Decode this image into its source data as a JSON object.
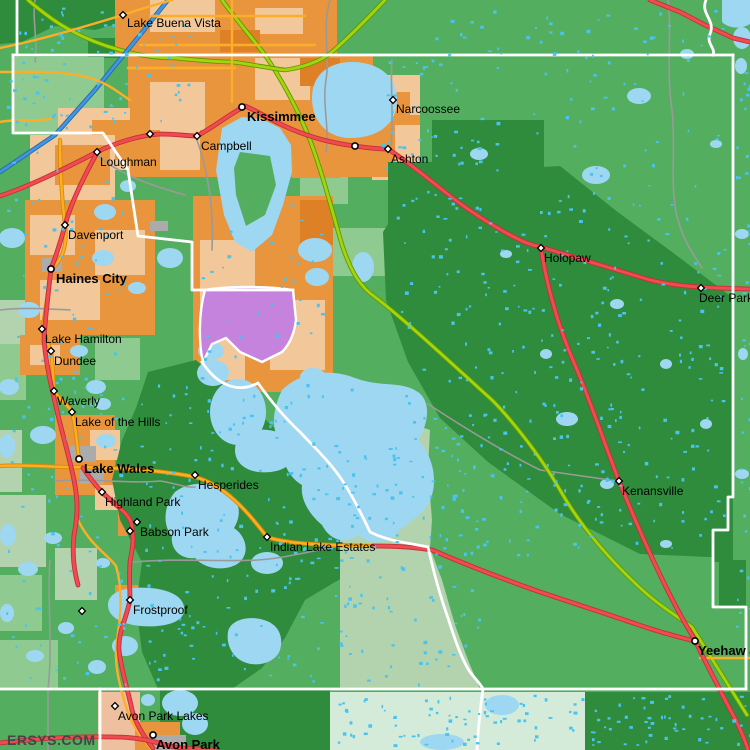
{
  "watermark": "ERSYS.COM",
  "palette": {
    "map_bg_green": "#54AE60",
    "dark_green": "#2E8C3C",
    "light_green": "#8FCB90",
    "sage_green": "#B2D3AE",
    "mint_green": "#D5EBDA",
    "orange_urban": "#E8953D",
    "tan_urban": "#F2C89B",
    "dark_orange": "#DD8026",
    "peach_urban": "#EFC0A0",
    "purple_area": "#C583DD",
    "gray_urban": "#ABABAB",
    "lake_blue": "#9ED7F2",
    "speckle_blue": "#49C3F0",
    "road_red": "#EF4B50",
    "road_yellow": "#FDAE28",
    "road_chartreuse": "#A5D40E",
    "road_blue": "#3F97E0",
    "road_gray": "#9A9A9A",
    "boundary_white": "#FFFFFF",
    "label_color": "#000000",
    "watermark_color": "#454545"
  },
  "towns": [
    {
      "label": "Lake Buena Vista",
      "marker": "diamond",
      "mx": 123,
      "my": 15,
      "lx": 127,
      "ly": 27,
      "bold": false
    },
    {
      "label": "Kissimmee",
      "marker": "circle",
      "mx": 242,
      "my": 107,
      "lx": 247,
      "ly": 121,
      "bold": true
    },
    {
      "label": "Narcoossee",
      "marker": "diamond",
      "mx": 393,
      "my": 100,
      "lx": 396,
      "ly": 113,
      "bold": false
    },
    {
      "label": "Campbell",
      "marker": "diamond",
      "mx": 197,
      "my": 136,
      "lx": 201,
      "ly": 150,
      "bold": false
    },
    {
      "label": "Ashton",
      "marker": "diamond",
      "mx": 388,
      "my": 149,
      "lx": 391,
      "ly": 163,
      "bold": false
    },
    {
      "label": "Loughman",
      "marker": "diamond",
      "mx": 97,
      "my": 152,
      "lx": 100,
      "ly": 166,
      "bold": false
    },
    {
      "label": "Davenport",
      "marker": "diamond",
      "mx": 65,
      "my": 225,
      "lx": 68,
      "ly": 239,
      "bold": false
    },
    {
      "label": "Haines City",
      "marker": "circle",
      "mx": 51,
      "my": 269,
      "lx": 56,
      "ly": 283,
      "bold": true
    },
    {
      "label": "Holopaw",
      "marker": "diamond",
      "mx": 541,
      "my": 248,
      "lx": 544,
      "ly": 262,
      "bold": false
    },
    {
      "label": "Deer Park",
      "marker": "diamond",
      "mx": 701,
      "my": 288,
      "lx": 699,
      "ly": 302,
      "bold": false
    },
    {
      "label": "Lake Hamilton",
      "marker": "diamond",
      "mx": 42,
      "my": 329,
      "lx": 45,
      "ly": 343,
      "bold": false
    },
    {
      "label": "Dundee",
      "marker": "diamond",
      "mx": 51,
      "my": 351,
      "lx": 54,
      "ly": 365,
      "bold": false
    },
    {
      "label": "Waverly",
      "marker": "diamond",
      "mx": 54,
      "my": 391,
      "lx": 57,
      "ly": 405,
      "bold": false
    },
    {
      "label": "Lake of the Hills",
      "marker": "diamond",
      "mx": 72,
      "my": 412,
      "lx": 75,
      "ly": 426,
      "bold": false
    },
    {
      "label": "Lake Wales",
      "marker": "circle",
      "mx": 79,
      "my": 459,
      "lx": 84,
      "ly": 473,
      "bold": true
    },
    {
      "label": "Hesperides",
      "marker": "diamond",
      "mx": 195,
      "my": 475,
      "lx": 198,
      "ly": 489,
      "bold": false
    },
    {
      "label": "Highland Park",
      "marker": "diamond",
      "mx": 102,
      "my": 492,
      "lx": 105,
      "ly": 506,
      "bold": false
    },
    {
      "label": "Babson Park",
      "marker": "diamond",
      "mx": 137,
      "my": 522,
      "lx": 140,
      "ly": 536,
      "bold": false
    },
    {
      "label": "Indian Lake Estates",
      "marker": "diamond",
      "mx": 267,
      "my": 537,
      "lx": 270,
      "ly": 551,
      "bold": false
    },
    {
      "label": "Kenansville",
      "marker": "diamond",
      "mx": 619,
      "my": 481,
      "lx": 622,
      "ly": 495,
      "bold": false
    },
    {
      "label": "Frostproof",
      "marker": "diamond",
      "mx": 130,
      "my": 600,
      "lx": 133,
      "ly": 614,
      "bold": false
    },
    {
      "label": "Yeehaw J",
      "marker": "circle",
      "mx": 695,
      "my": 641,
      "lx": 698,
      "ly": 655,
      "bold": true
    },
    {
      "label": "Avon Park Lakes",
      "marker": "diamond",
      "mx": 115,
      "my": 706,
      "lx": 118,
      "ly": 720,
      "bold": false
    },
    {
      "label": "Avon Park",
      "marker": "circle",
      "mx": 153,
      "my": 735,
      "lx": 156,
      "ly": 749,
      "bold": true
    }
  ],
  "unlabeled_markers": [
    {
      "marker": "circle",
      "mx": 355,
      "my": 146
    },
    {
      "marker": "diamond",
      "mx": 150,
      "my": 134
    },
    {
      "marker": "diamond",
      "mx": 82,
      "my": 611
    },
    {
      "marker": "diamond",
      "mx": 130,
      "my": 531
    }
  ]
}
